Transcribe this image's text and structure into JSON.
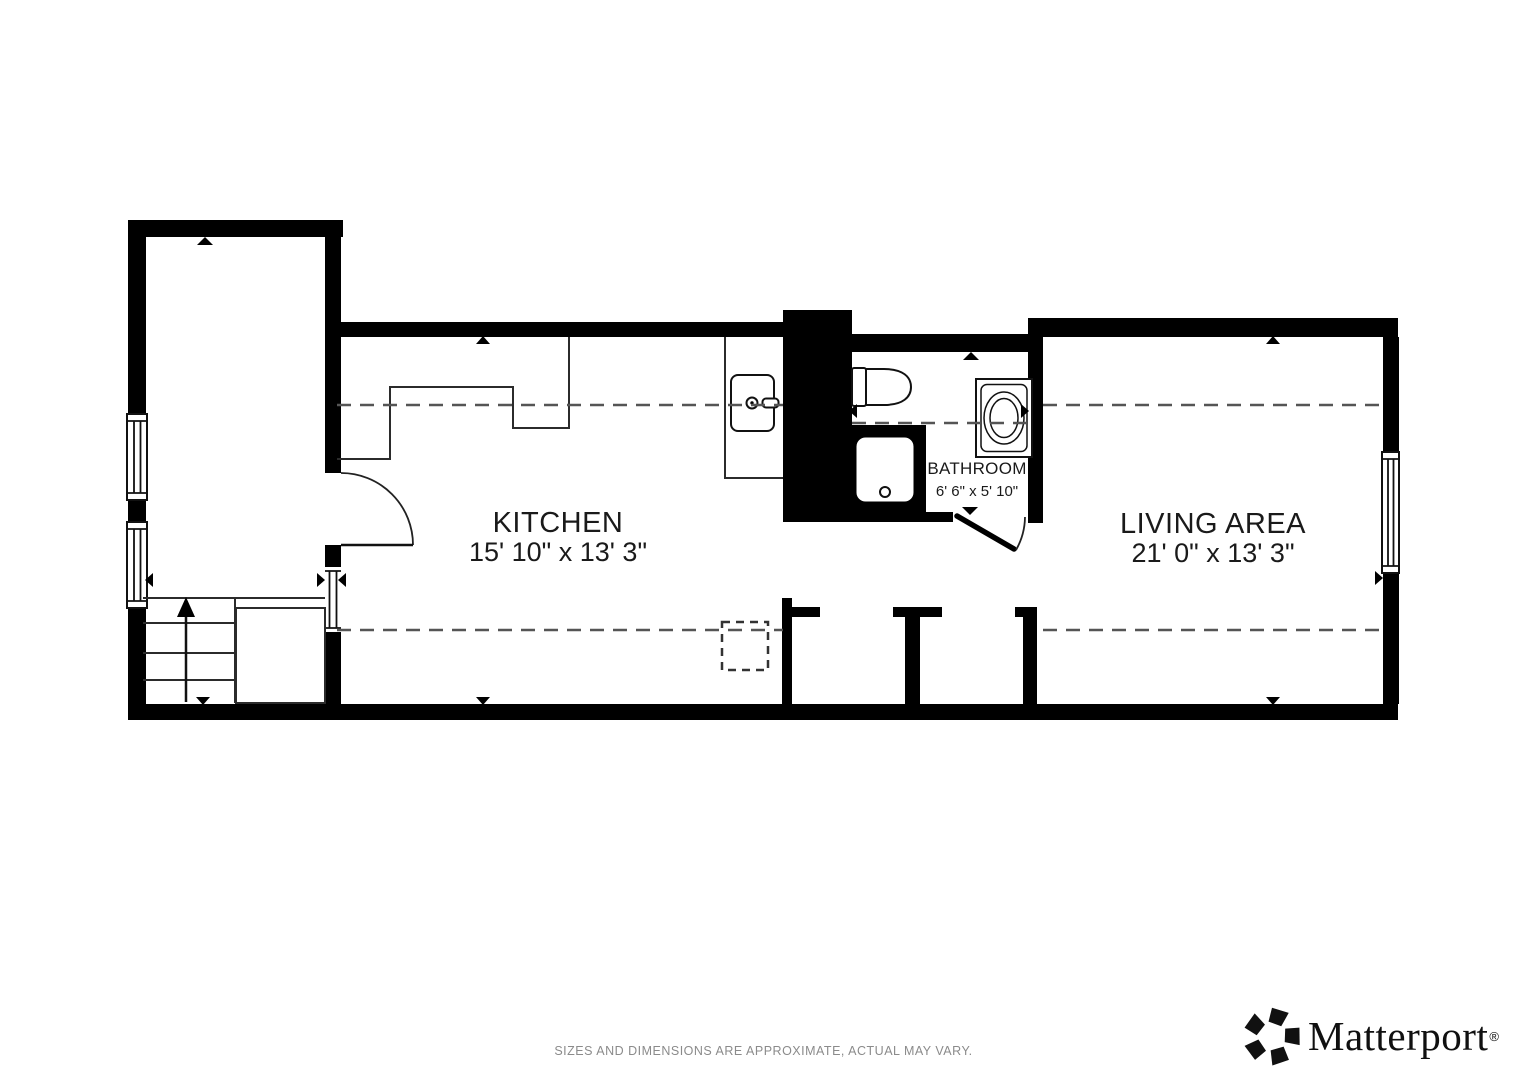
{
  "rooms": {
    "kitchen": {
      "name": "KITCHEN",
      "dimensions": "15' 10\" x 13' 3\""
    },
    "living_area": {
      "name": "LIVING AREA",
      "dimensions": "21' 0\" x 13' 3\""
    },
    "bathroom": {
      "name": "BATHROOM",
      "dimensions": "6' 6\" x 5' 10\""
    }
  },
  "fixtures": {
    "stairs": "staircase-with-up-arrow",
    "bathroom_items": [
      "toilet",
      "shower",
      "washer"
    ],
    "kitchen_items": [
      "counter",
      "sink-with-faucet"
    ]
  },
  "footer": {
    "disclaimer": "SIZES AND DIMENSIONS ARE APPROXIMATE, ACTUAL MAY VARY."
  },
  "branding": {
    "logo_text": "Matterport",
    "registered_mark": "®"
  },
  "colors": {
    "wall": "#000000",
    "dash_line": "#555555",
    "label_text": "#1a1a1a",
    "disclaimer_text": "#8b8b8b",
    "logo_text": "#101010",
    "background": "#ffffff"
  }
}
